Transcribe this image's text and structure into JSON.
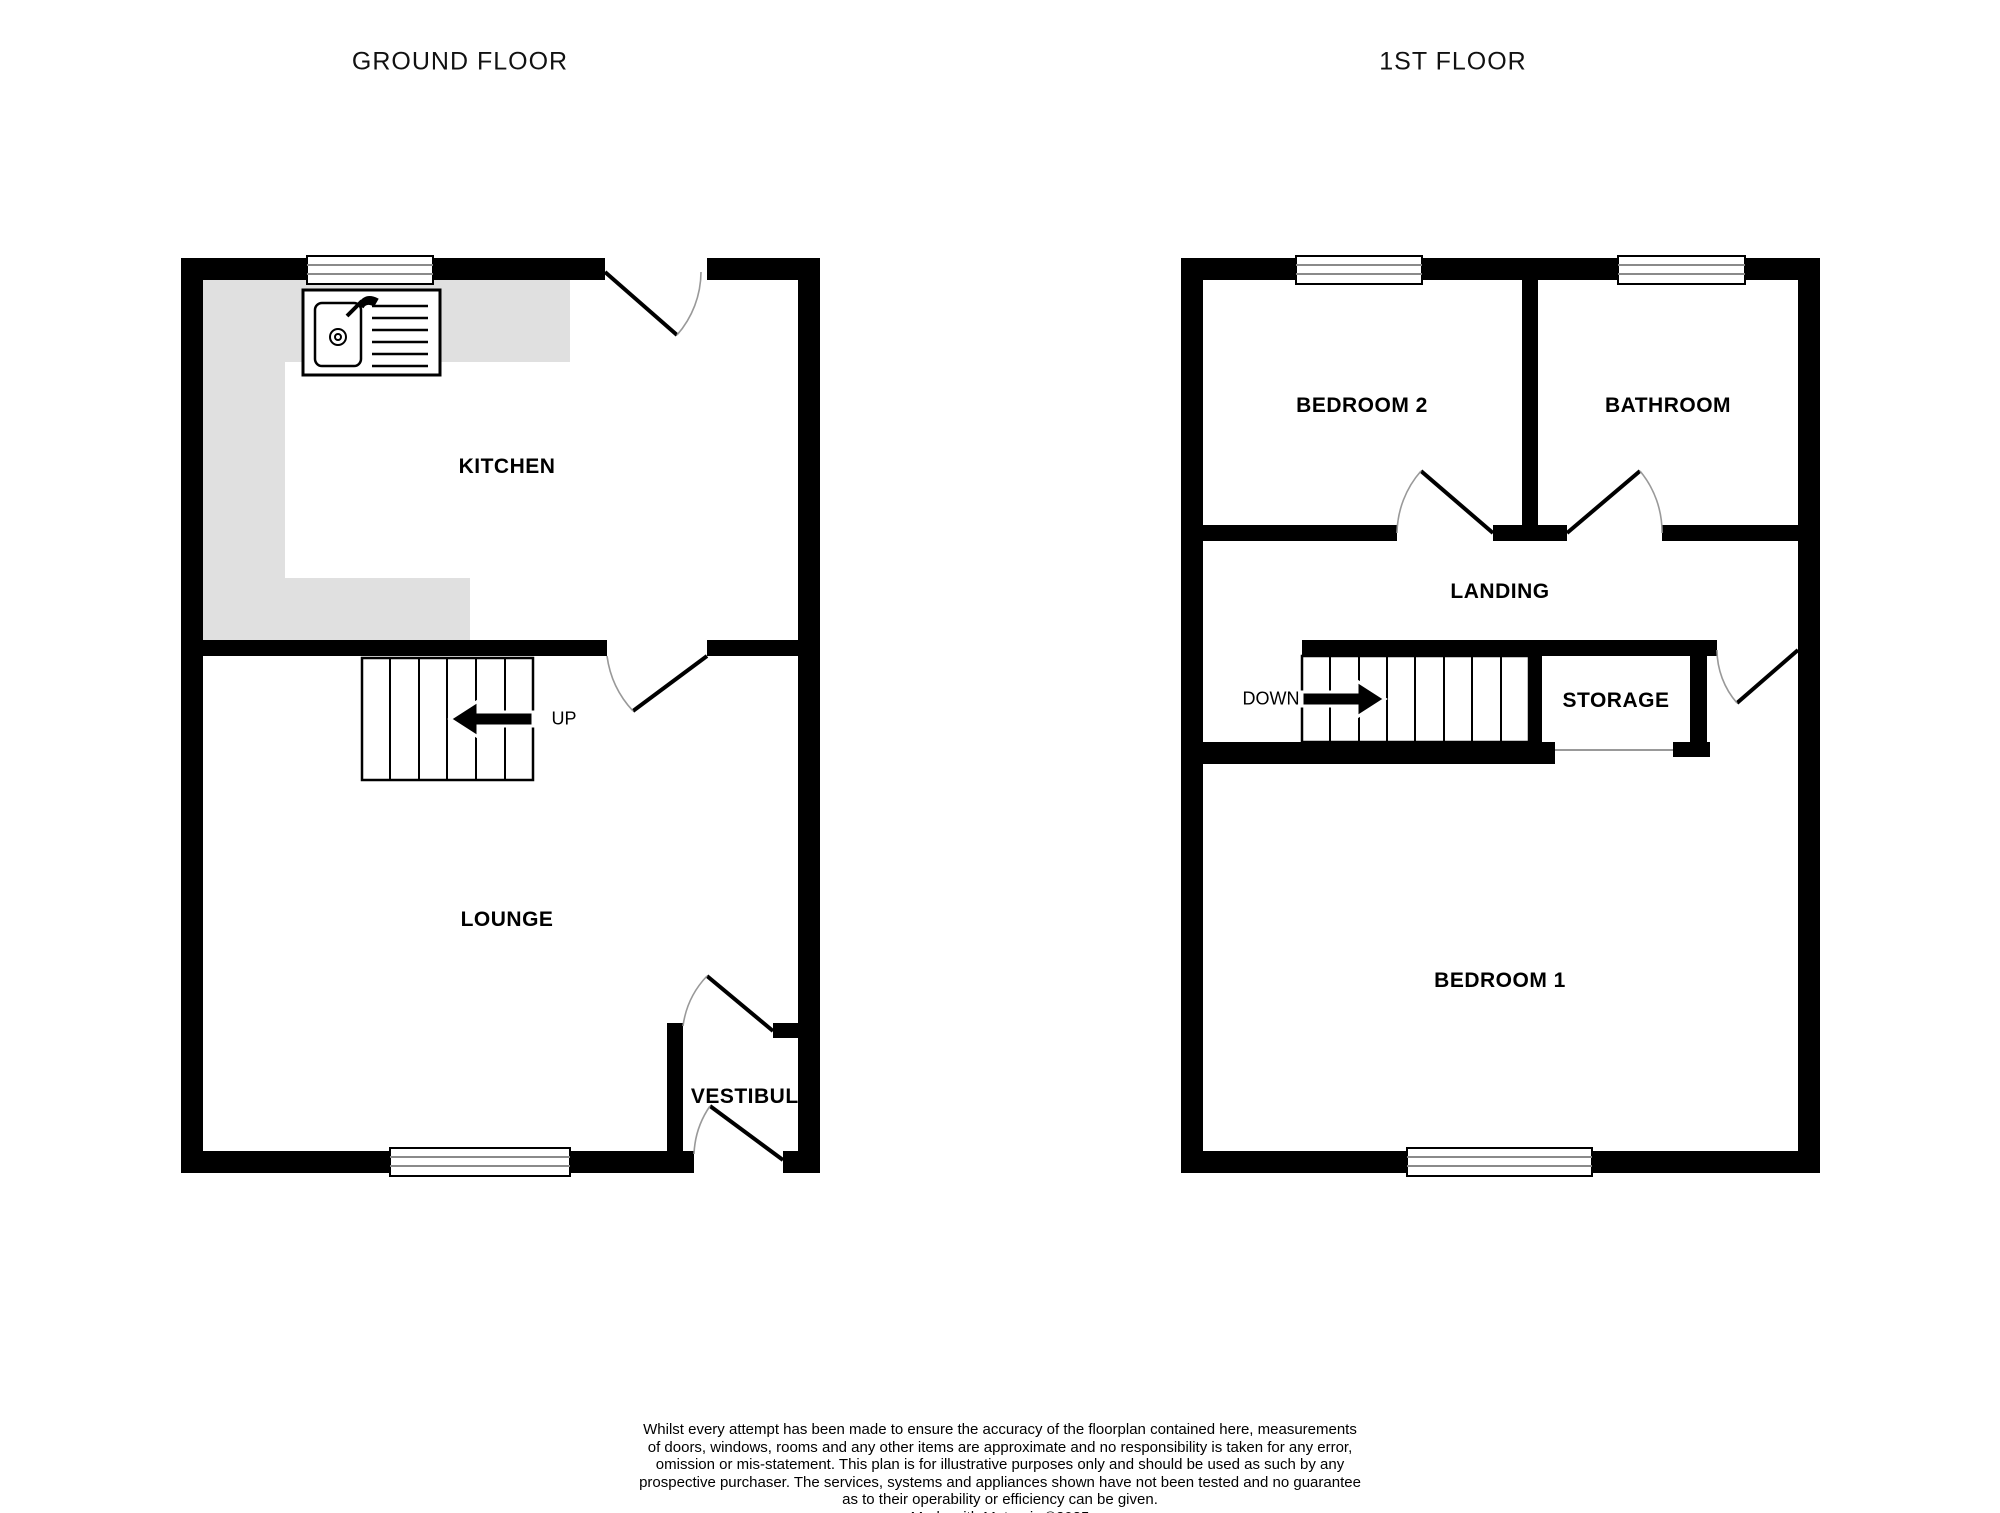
{
  "colors": {
    "wall": "#000000",
    "kitchen_counter": "#e0e0e0",
    "window_line": "#8a8a8a",
    "door_arc": "#999999",
    "background": "#ffffff"
  },
  "titles": {
    "ground": "GROUND FLOOR",
    "first": "1ST FLOOR"
  },
  "ground_floor": {
    "kitchen": "KITCHEN",
    "lounge": "LOUNGE",
    "vestibule": "VESTIBULE",
    "stairs_direction": "UP"
  },
  "first_floor": {
    "bedroom2": "BEDROOM 2",
    "bathroom": "BATHROOM",
    "landing": "LANDING",
    "storage": "STORAGE",
    "bedroom1": "BEDROOM 1",
    "stairs_direction": "DOWN"
  },
  "disclaimer": {
    "lines": [
      "Whilst every attempt has been made to ensure the accuracy of the floorplan contained here, measurements",
      "of doors, windows, rooms and any other items are approximate and no responsibility is taken for any error,",
      "omission or mis-statement. This plan is for illustrative purposes only and should be used as such by any",
      "prospective purchaser. The services, systems and appliances shown have not been tested and no guarantee",
      "as to their operability or efficiency can be given.",
      "Made with Metropix ©2025"
    ]
  }
}
